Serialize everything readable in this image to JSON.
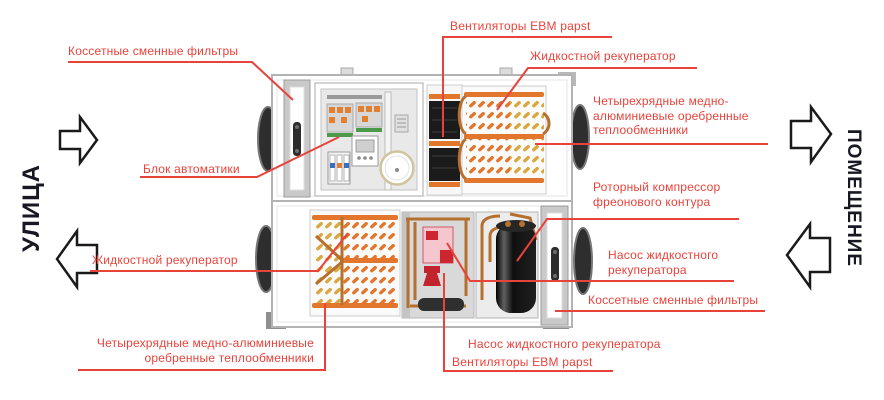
{
  "palette": {
    "label_red": "#e8433b",
    "side_text_dark": "#181822",
    "coil_orange": "#e2762c",
    "coil_gold": "#d9a93f",
    "copper_pipe": "#b5702f",
    "unit_outline": "#b3b3b3",
    "pump_pink": "#f5c6ce",
    "pump_red": "#cf2531"
  },
  "sides": {
    "left_label": "УЛИЦА",
    "right_label": "ПОМЕЩЕНИЕ"
  },
  "labels": {
    "filter_top": "Коссетные сменные фильтры",
    "fans_top": "Вентиляторы EBM papst",
    "recuperator_top": "Жидкостной рекуператор",
    "hx_right": {
      "line1": "Четырехрядные медно-",
      "line2": "алюминиевые оребренные",
      "line3": "теплообменники"
    },
    "automation": "Блок автоматики",
    "compressor": {
      "line1": "Роторный компрессор",
      "line2": "фреонового контура"
    },
    "pump_right": {
      "line1": "Насос жидкостного",
      "line2": "рекуператора"
    },
    "filter_right": "Коссетные сменные фильтры",
    "recuperator_bottom": "Жидкостной рекуператор",
    "hx_bottom": {
      "line1": "Четырехрядные медно-алюминиевые",
      "line2": "оребренные теплообменники"
    },
    "pump_bottom": "Насос жидкостного рекуператора",
    "fans_bottom": "Вентиляторы EBM papst"
  }
}
